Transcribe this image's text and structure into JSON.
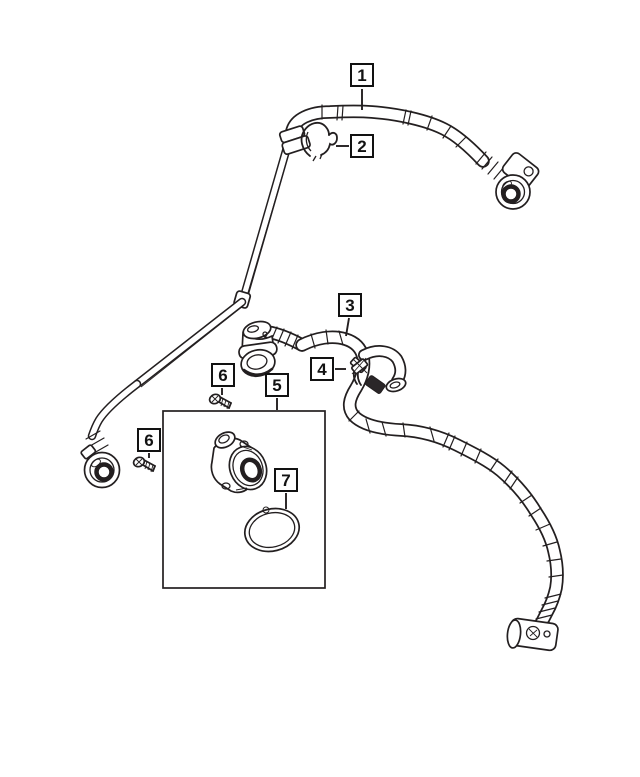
{
  "page": {
    "background": "#ffffff"
  },
  "diagram": {
    "kind": "parts-line-art",
    "line_color": "#231f20",
    "callout_border_color": "#121212",
    "callouts": [
      {
        "label": "1"
      },
      {
        "label": "2"
      },
      {
        "label": "3"
      },
      {
        "label": "4"
      },
      {
        "label": "5"
      },
      {
        "label": "6"
      },
      {
        "label": "6"
      },
      {
        "label": "7"
      }
    ]
  }
}
